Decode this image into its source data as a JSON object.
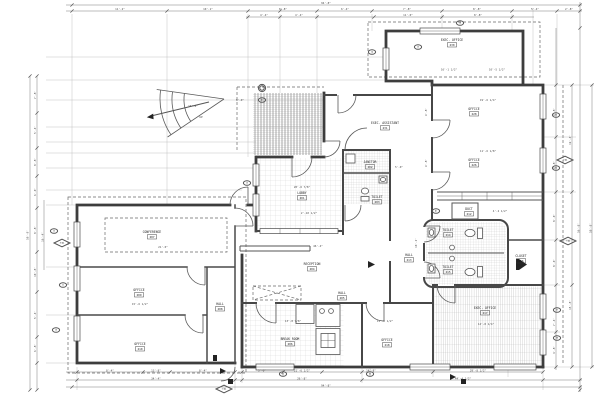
{
  "drawing": {
    "background": "#ffffff",
    "line_color": "#3d3d3d",
    "dim_color": "#7a7a7a"
  },
  "rooms": [
    {
      "name": "exec-office-230",
      "label": "EXEC. OFFICE",
      "number": "230",
      "x": 452,
      "y": 41
    },
    {
      "name": "office-228",
      "label": "OFFICE",
      "number": "228",
      "x": 474,
      "y": 110
    },
    {
      "name": "office-226",
      "label": "OFFICE",
      "number": "226",
      "x": 474,
      "y": 161
    },
    {
      "name": "exec-assistant-231",
      "label": "EXEC. ASSISTANT",
      "number": "231",
      "x": 385,
      "y": 124
    },
    {
      "name": "lobby-201",
      "label": "LOBBY",
      "number": "201",
      "x": 302,
      "y": 194
    },
    {
      "name": "janitor-202",
      "label": "JANITOR",
      "number": "202",
      "x": 370,
      "y": 163
    },
    {
      "name": "toilet-203",
      "label": "TOILET",
      "number": "203",
      "x": 377,
      "y": 198
    },
    {
      "name": "reception-204",
      "label": "RECEPTION",
      "number": "204",
      "x": 312,
      "y": 265
    },
    {
      "name": "hall-205",
      "label": "HALL",
      "number": "205",
      "x": 342,
      "y": 294
    },
    {
      "name": "break-room-206",
      "label": "BREAK ROOM",
      "number": "206",
      "x": 290,
      "y": 340
    },
    {
      "name": "conference-207",
      "label": "CONFERENCE",
      "number": "207",
      "x": 152,
      "y": 233
    },
    {
      "name": "hall-208",
      "label": "HALL",
      "number": "208",
      "x": 220,
      "y": 305
    },
    {
      "name": "office-209",
      "label": "OFFICE",
      "number": "209",
      "x": 139,
      "y": 291
    },
    {
      "name": "office-210",
      "label": "OFFICE",
      "number": "210",
      "x": 140,
      "y": 345
    },
    {
      "name": "duct-212",
      "label": "DUCT",
      "number": "212",
      "x": 469,
      "y": 210
    },
    {
      "name": "hall-213",
      "label": "HALL",
      "number": "213",
      "x": 409,
      "y": 256
    },
    {
      "name": "toilet-214",
      "label": "TOILET",
      "number": "214",
      "x": 448,
      "y": 231
    },
    {
      "name": "toilet-215",
      "label": "TOILET",
      "number": "215",
      "x": 448,
      "y": 268
    },
    {
      "name": "closet-216",
      "label": "CLOSET",
      "number": "216",
      "x": 521,
      "y": 257
    },
    {
      "name": "exec-office-217",
      "label": "EXEC. OFFICE",
      "number": "217",
      "x": 485,
      "y": 309
    },
    {
      "name": "office-218",
      "label": "OFFICE",
      "number": "218",
      "x": 387,
      "y": 341
    }
  ],
  "dim_texts": [
    {
      "t": "94'-8\"",
      "x": 326,
      "y": 4.2
    },
    {
      "t": "11'-2\"",
      "x": 120,
      "y": 10.2
    },
    {
      "t": "10'-1\"",
      "x": 208,
      "y": 10.2
    },
    {
      "t": "8'-8\"",
      "x": 283,
      "y": 10.2
    },
    {
      "t": "6'-4\"",
      "x": 345,
      "y": 10.2
    },
    {
      "t": "7'-8\"",
      "x": 407,
      "y": 10.2
    },
    {
      "t": "8'-8\"",
      "x": 477,
      "y": 10.2
    },
    {
      "t": "5'-4\"",
      "x": 535,
      "y": 10.2
    },
    {
      "t": "2'-8\"",
      "x": 569,
      "y": 10.2
    },
    {
      "t": "4'-4\"",
      "x": 264,
      "y": 16.2
    },
    {
      "t": "4'-4\"",
      "x": 299,
      "y": 16.2
    },
    {
      "t": "11'-0\"",
      "x": 408,
      "y": 16.2
    },
    {
      "t": "8'-8\"",
      "x": 478,
      "y": 16.2
    },
    {
      "t": "58'-8\"",
      "x": 28.5,
      "y": 235,
      "r": -90
    },
    {
      "t": "7'-8\"",
      "x": 36,
      "y": 95,
      "r": -90
    },
    {
      "t": "5'-4\"",
      "x": 36,
      "y": 130,
      "r": -90
    },
    {
      "t": "8'-8\"",
      "x": 36,
      "y": 162,
      "r": -90
    },
    {
      "t": "6'-0\"",
      "x": 36,
      "y": 192,
      "r": -90
    },
    {
      "t": "8'-8\"",
      "x": 36,
      "y": 230,
      "r": -90
    },
    {
      "t": "10'-8\"",
      "x": 36,
      "y": 272,
      "r": -90
    },
    {
      "t": "5'-4\"",
      "x": 36,
      "y": 315,
      "r": -90
    },
    {
      "t": "6'-8\"",
      "x": 36,
      "y": 348,
      "r": -90
    },
    {
      "t": "16'-4\"",
      "x": 43.5,
      "y": 237,
      "r": -90
    },
    {
      "t": "9'-8\"",
      "x": 555,
      "y": 112,
      "r": -90
    },
    {
      "t": "9'-8\"",
      "x": 555,
      "y": 165,
      "r": -90
    },
    {
      "t": "8'-0\"",
      "x": 555,
      "y": 218,
      "r": -90
    },
    {
      "t": "8'-0\"",
      "x": 555,
      "y": 263,
      "r": -90
    },
    {
      "t": "7'-4\"",
      "x": 555,
      "y": 322,
      "r": -90
    },
    {
      "t": "4'-8\"",
      "x": 555,
      "y": 350,
      "r": -90
    },
    {
      "t": "19'-4\"",
      "x": 571,
      "y": 140,
      "r": -90
    },
    {
      "t": "15'-8\"",
      "x": 571,
      "y": 305,
      "r": -90
    },
    {
      "t": "56'-8\"",
      "x": 579.5,
      "y": 228,
      "r": -90
    },
    {
      "t": "58'-8\"",
      "x": 591.5,
      "y": 228,
      "r": -90
    },
    {
      "t": "8'-4\"",
      "x": 110,
      "y": 371.4
    },
    {
      "t": "13'-8\"",
      "x": 156,
      "y": 371.4
    },
    {
      "t": "8'-4\"",
      "x": 203,
      "y": 371.4
    },
    {
      "t": "5'-0\"",
      "x": 262,
      "y": 371.4
    },
    {
      "t": "21'-6 1/2\"",
      "x": 302,
      "y": 371.4
    },
    {
      "t": "14'-8\"",
      "x": 371,
      "y": 371.4
    },
    {
      "t": "29'-8 1/2\"",
      "x": 478,
      "y": 371.4
    },
    {
      "t": "34'-4\"",
      "x": 156,
      "y": 379.4
    },
    {
      "t": "26'-8\"",
      "x": 302,
      "y": 379.4
    },
    {
      "t": "44'-4 1/2\"",
      "x": 463,
      "y": 379.4
    },
    {
      "t": "94'-8\"",
      "x": 326,
      "y": 386.4
    },
    {
      "t": "16'-1 1/2\"",
      "x": 449,
      "y": 70.5
    },
    {
      "t": "10'-5 1/2\"",
      "x": 497,
      "y": 70.5
    },
    {
      "t": "19'-6 1/4\"",
      "x": 488,
      "y": 101
    },
    {
      "t": "11'-6 1/8\"",
      "x": 488,
      "y": 152
    },
    {
      "t": "9'-8\"",
      "x": 427,
      "y": 112,
      "r": -90
    },
    {
      "t": "9'-8\"",
      "x": 427,
      "y": 163,
      "r": -90
    },
    {
      "t": "8'-0\"",
      "x": 240,
      "y": 101
    },
    {
      "t": "16'-8\"",
      "x": 193,
      "y": 107
    },
    {
      "t": "UP",
      "x": 201,
      "y": 118
    },
    {
      "t": "20'-6 7/8\"",
      "x": 302,
      "y": 188
    },
    {
      "t": "2'-10 1/2\"",
      "x": 309,
      "y": 214
    },
    {
      "t": "21'-0\"",
      "x": 163,
      "y": 248
    },
    {
      "t": "46'-4\"",
      "x": 318,
      "y": 247
    },
    {
      "t": "15'-6 1/2\"",
      "x": 140,
      "y": 305
    },
    {
      "t": "13'-8 7/8\"",
      "x": 293,
      "y": 322
    },
    {
      "t": "11'-6 1/2\"",
      "x": 385,
      "y": 322
    },
    {
      "t": "14'-8 1/4\"",
      "x": 486,
      "y": 325
    },
    {
      "t": "10'-2\"",
      "x": 417,
      "y": 243,
      "r": -90
    },
    {
      "t": "5'-0\"",
      "x": 399,
      "y": 168
    },
    {
      "t": "4'-2 1/2\"",
      "x": 500,
      "y": 212
    }
  ],
  "tags": [
    {
      "t": "16",
      "x": 460,
      "y": 23
    },
    {
      "t": "15",
      "x": 418,
      "y": 47
    },
    {
      "t": "14",
      "x": 372,
      "y": 52
    },
    {
      "t": "A1",
      "x": 262,
      "y": 100
    },
    {
      "t": "13",
      "x": 247,
      "y": 183
    },
    {
      "t": "12",
      "x": 54,
      "y": 231
    },
    {
      "t": "11",
      "x": 63,
      "y": 285
    },
    {
      "t": "10",
      "x": 56,
      "y": 330
    },
    {
      "t": "05",
      "x": 556,
      "y": 115
    },
    {
      "t": "06",
      "x": 556,
      "y": 168
    },
    {
      "t": "07",
      "x": 557,
      "y": 310
    },
    {
      "t": "08",
      "x": 557,
      "y": 338
    },
    {
      "t": "02",
      "x": 283,
      "y": 374
    },
    {
      "t": "03",
      "x": 370,
      "y": 374
    },
    {
      "t": "AC",
      "x": 436,
      "y": 211
    }
  ],
  "markers": [
    {
      "t": "8/A4",
      "x": 62,
      "y": 243
    },
    {
      "t": "6/A4",
      "x": 565,
      "y": 160
    },
    {
      "t": "7/A4",
      "x": 568,
      "y": 241
    },
    {
      "t": "5/A4",
      "x": 224,
      "y": 389
    }
  ]
}
